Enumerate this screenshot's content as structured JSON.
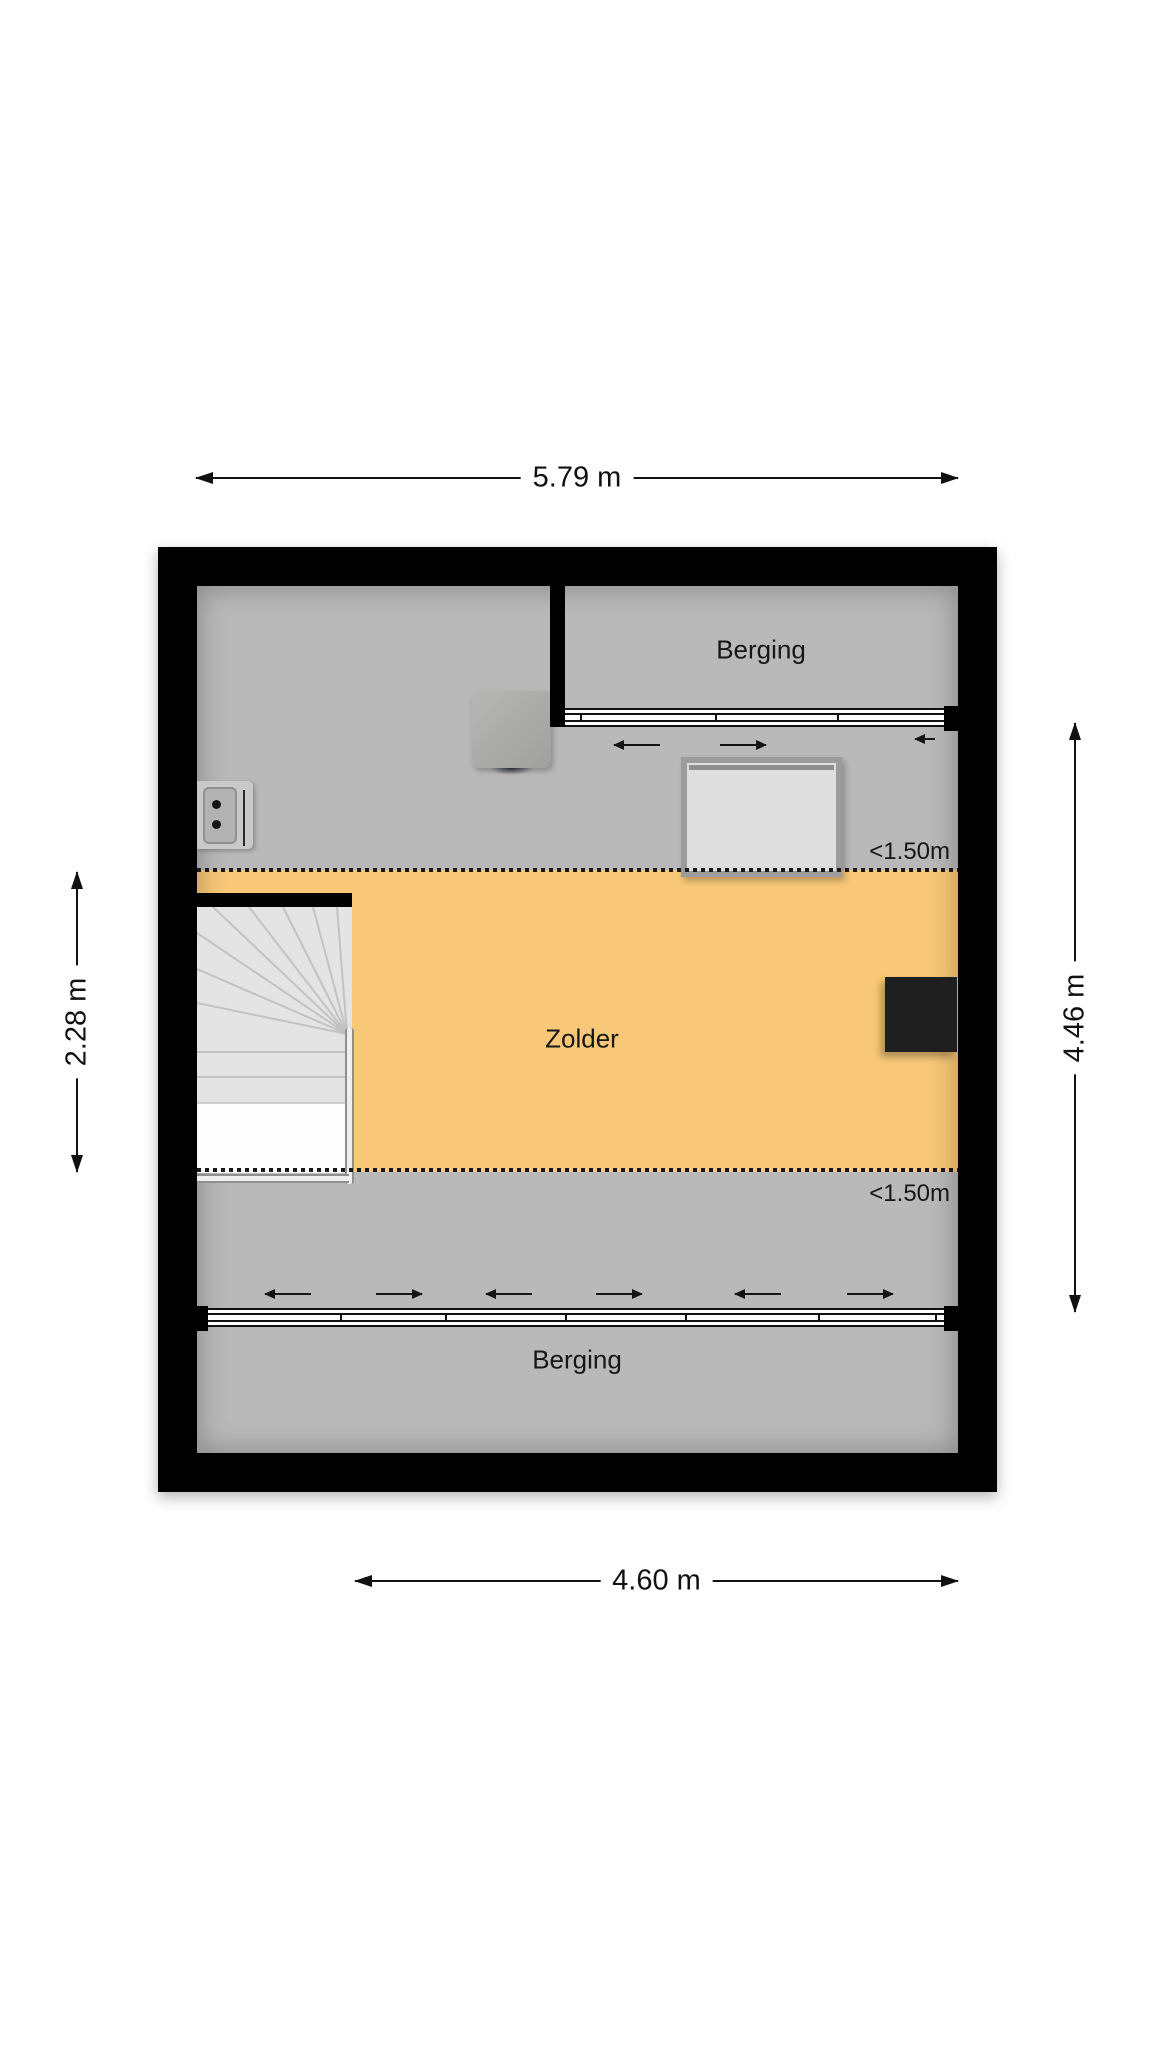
{
  "plan": {
    "dimensions": {
      "top": "5.79 m",
      "bottom": "4.60 m",
      "left": "2.28 m",
      "right": "4.46 m"
    },
    "rooms": {
      "berging_top": "Berging",
      "zolder": "Zolder",
      "berging_bottom": "Berging"
    },
    "height_markers": {
      "upper": "<1.50m",
      "lower": "<1.50m"
    },
    "colors": {
      "wall": "#000000",
      "low_headroom_floor": "#b9b9b9",
      "main_floor_zone": "#f8c878",
      "dimension_text": "#111111"
    },
    "tracks": {
      "top_arrows": [
        "left",
        "right",
        "left"
      ],
      "bottom_arrows": [
        "left",
        "right",
        "left",
        "right",
        "left",
        "right"
      ]
    }
  }
}
